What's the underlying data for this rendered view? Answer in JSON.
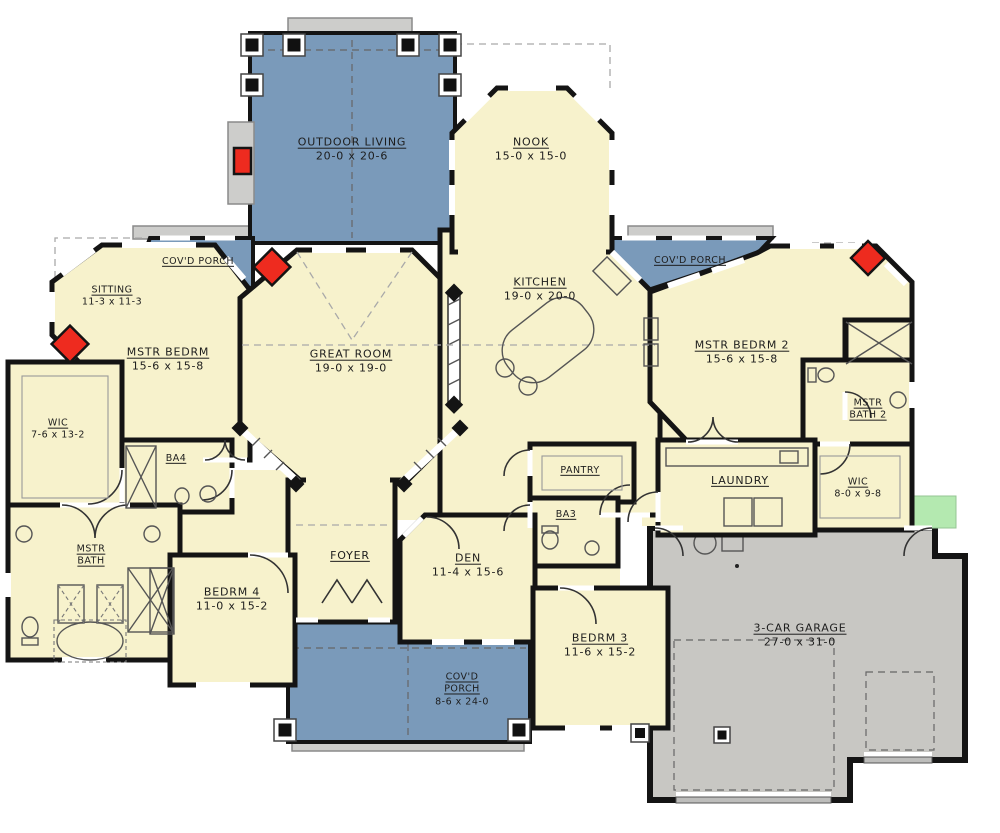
{
  "palette": {
    "interior_cream": "#F7F2CC",
    "porch_blue": "#7A9ABA",
    "garage_gray": "#C8C7C3",
    "step_gray": "#CDCDCB",
    "stoop_green": "#B4E9B0",
    "fireplace_red": "#EE2B1F",
    "wall_black": "#141414"
  },
  "rooms": {
    "outdoor_living": {
      "name": "OUTDOOR LIVING",
      "dims": "20-0 x 20-6"
    },
    "nook": {
      "name": "NOOK",
      "dims": "15-0 x 15-0"
    },
    "covd_porch_left": {
      "name": "COV'D PORCH"
    },
    "covd_porch_right": {
      "name": "COV'D PORCH"
    },
    "sitting": {
      "name": "SITTING",
      "dims": "11-3 x 11-3"
    },
    "mstr_bedrm": {
      "name": "MSTR BEDRM",
      "dims": "15-6 x 15-8"
    },
    "great_room": {
      "name": "GREAT ROOM",
      "dims": "19-0 x 19-0"
    },
    "kitchen": {
      "name": "KITCHEN",
      "dims": "19-0 x 20-0"
    },
    "mstr_bedrm_2": {
      "name": "MSTR BEDRM 2",
      "dims": "15-6 x 15-8"
    },
    "wic_left": {
      "name": "WIC",
      "dims": "7-6 x 13-2"
    },
    "ba4": {
      "name": "BA4"
    },
    "mstr_bath": {
      "name": "MSTR",
      "name2": "BATH"
    },
    "mstr_bath_2": {
      "name": "MSTR",
      "name2": "BATH 2"
    },
    "pantry": {
      "name": "PANTRY"
    },
    "ba3": {
      "name": "BA3"
    },
    "laundry": {
      "name": "LAUNDRY"
    },
    "wic_right": {
      "name": "WIC",
      "dims": "8-0 x 9-8"
    },
    "foyer": {
      "name": "FOYER"
    },
    "den": {
      "name": "DEN",
      "dims": "11-4 x 15-6"
    },
    "bedrm4": {
      "name": "BEDRM 4",
      "dims": "11-0 x 15-2"
    },
    "covd_porch_bottom": {
      "name": "COV'D",
      "name2": "PORCH",
      "dims": "8-6 x 24-0"
    },
    "bedrm3": {
      "name": "BEDRM 3",
      "dims": "11-6 x 15-2"
    },
    "garage": {
      "name": "3-CAR GARAGE",
      "dims": "27-0 x 31-0"
    }
  }
}
